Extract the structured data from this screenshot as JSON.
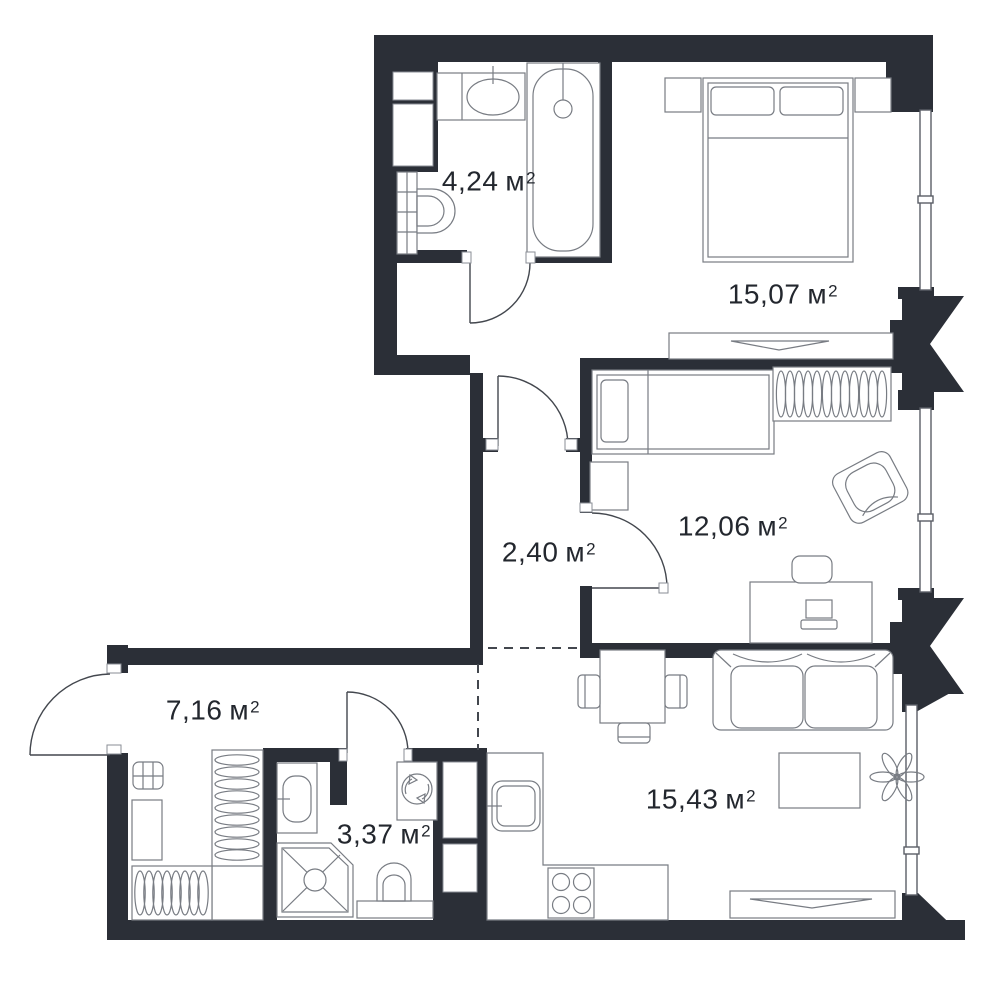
{
  "labels": {
    "unit": "м",
    "sup": "2"
  },
  "rooms": [
    {
      "id": "bathroom",
      "area": "4,24"
    },
    {
      "id": "bedroom",
      "area": "15,07"
    },
    {
      "id": "room",
      "area": "12,06"
    },
    {
      "id": "hallway",
      "area": "2,40"
    },
    {
      "id": "corridor",
      "area": "7,16"
    },
    {
      "id": "shower-room",
      "area": "3,37"
    },
    {
      "id": "living-kitchen",
      "area": "15,43"
    }
  ],
  "colors": {
    "wall": "#2b2f37",
    "furniture_line": "#787c83",
    "door_line": "#43474e",
    "text": "#23272e",
    "background": "#ffffff"
  }
}
